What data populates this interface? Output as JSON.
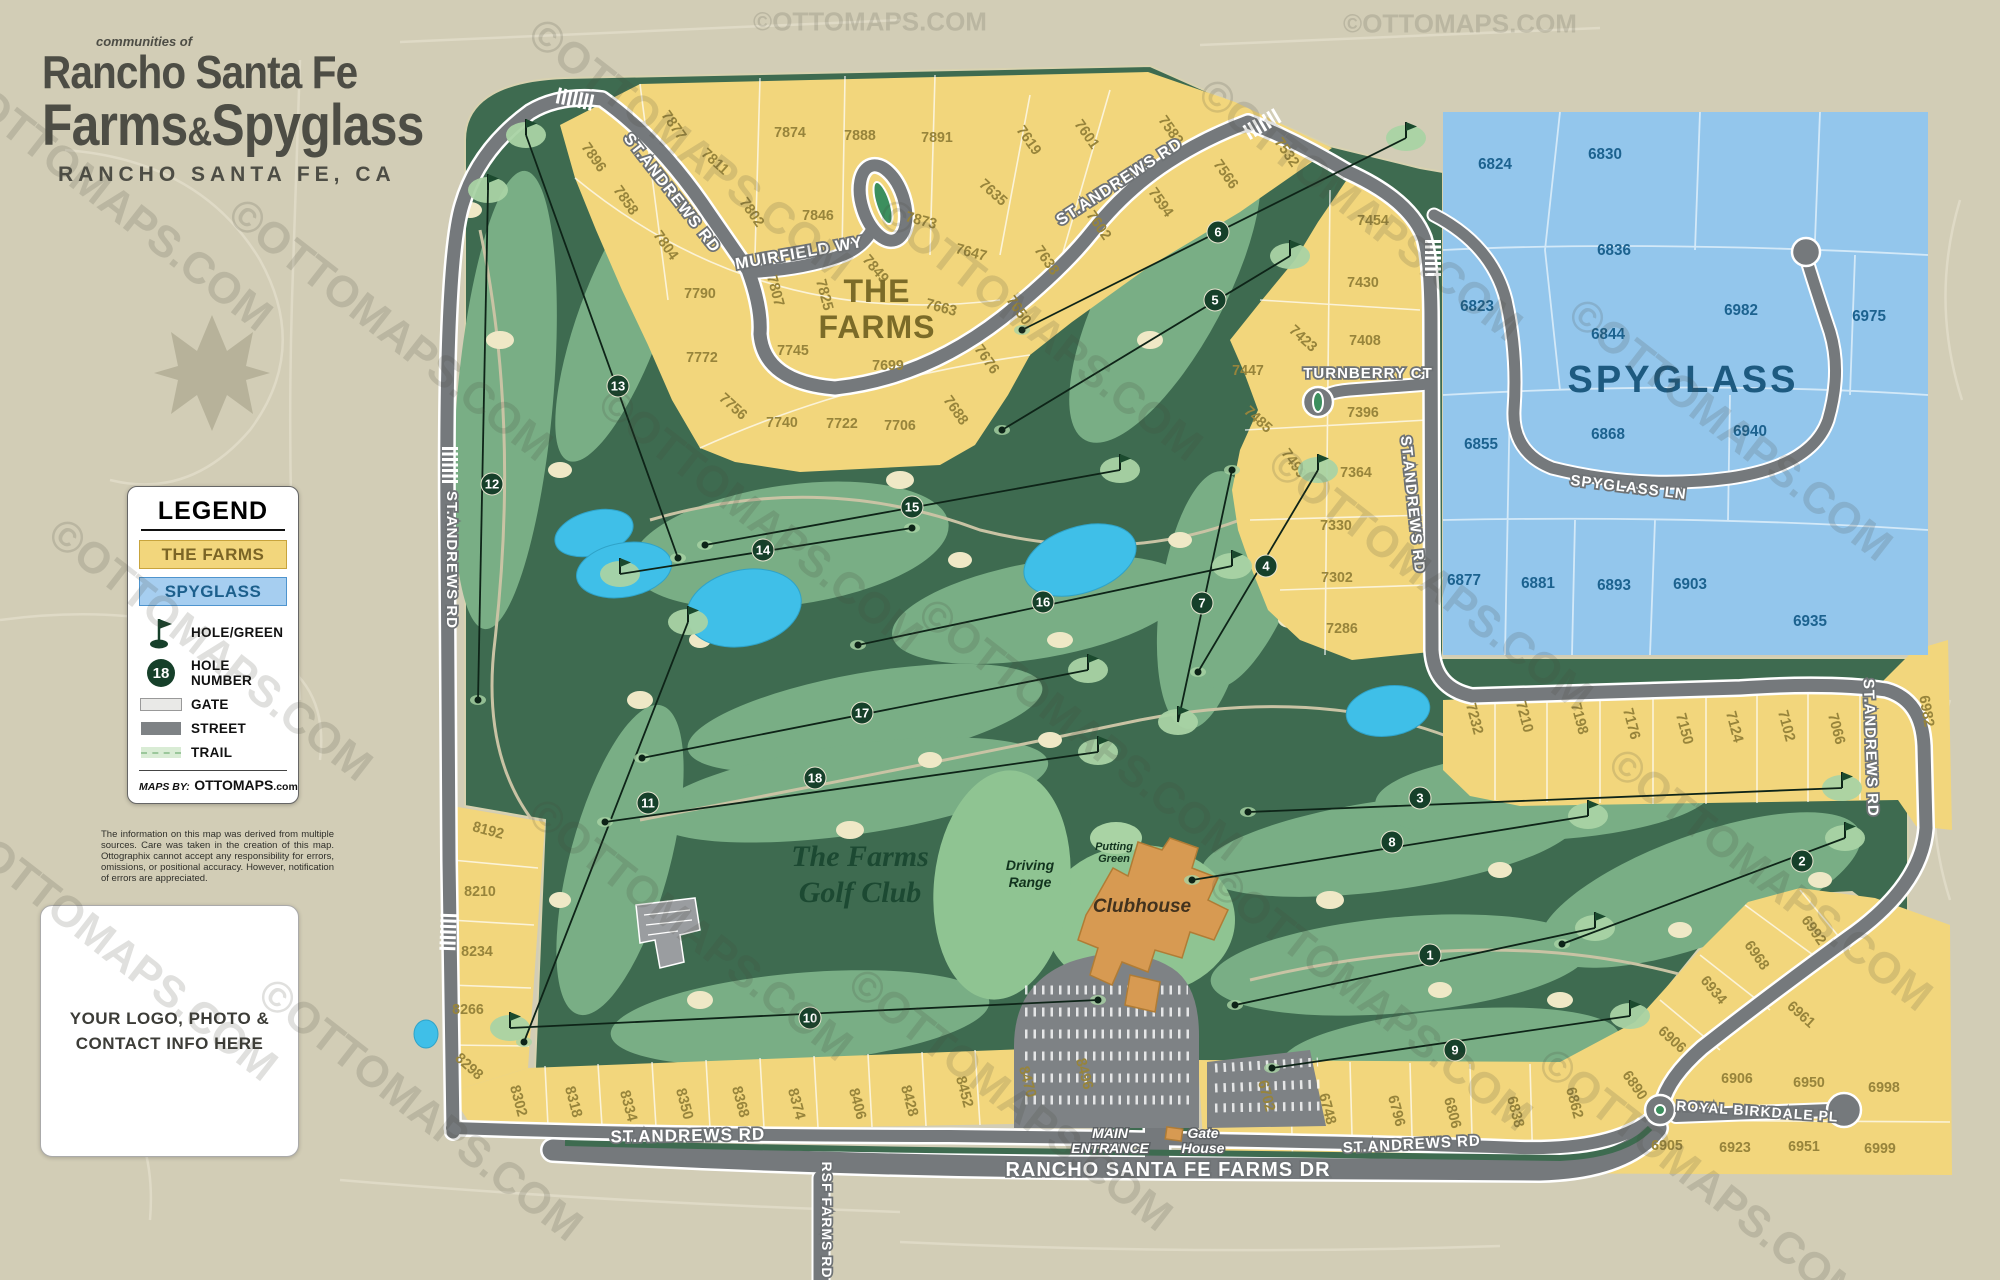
{
  "title": {
    "kicker": "communities of",
    "line1": "Rancho Santa Fe",
    "line2_a": "Farms",
    "amp": "&",
    "line2_b": "Spyglass",
    "subtitle": "RANCHO SANTA FE, CA"
  },
  "legend": {
    "heading": "LEGEND",
    "farms_label": "THE FARMS",
    "spyglass_label": "SPYGLASS",
    "hole_green_label": "HOLE/GREEN",
    "hole_number_label": "HOLE NUMBER",
    "hole_number_example": "18",
    "gate_label": "GATE",
    "street_label": "STREET",
    "trail_label": "TRAIL",
    "maps_by": "MAPS BY:",
    "brand": "OTTOMAPS",
    "brand_suffix": ".com"
  },
  "disclaimer": "The information on this map was derived from multiple sources. Care was taken in the creation of this map. Ottographix cannot accept any responsibility for errors, omissions, or positional accuracy. However, notification of errors are appreciated.",
  "logo_box": {
    "line1": "YOUR LOGO, PHOTO &",
    "line2": "CONTACT INFO HERE"
  },
  "watermark": {
    "text": "©OTTOMAPS.COM",
    "positions": [
      [
        870,
        22,
        26,
        0
      ],
      [
        1460,
        24,
        26,
        0
      ],
      [
        110,
        200,
        44,
        38
      ],
      [
        390,
        330,
        44,
        38
      ],
      [
        210,
        650,
        44,
        38
      ],
      [
        115,
        950,
        44,
        38
      ],
      [
        420,
        1110,
        44,
        38
      ],
      [
        690,
        150,
        44,
        38
      ],
      [
        760,
        520,
        44,
        38
      ],
      [
        690,
        930,
        44,
        38
      ],
      [
        1040,
        330,
        44,
        38
      ],
      [
        1080,
        730,
        44,
        38
      ],
      [
        1010,
        1100,
        44,
        38
      ],
      [
        1360,
        210,
        44,
        38
      ],
      [
        1430,
        580,
        44,
        38
      ],
      [
        1370,
        1000,
        44,
        38
      ],
      [
        1730,
        430,
        44,
        38
      ],
      [
        1770,
        880,
        44,
        38
      ],
      [
        1700,
        1180,
        44,
        38
      ]
    ]
  },
  "colors": {
    "farms_fill": "#F2D67C",
    "farms_text": "#97843B",
    "spyglass_fill": "#93C6EC",
    "spyglass_text": "#1C628F",
    "course_green": "#3E6B50",
    "fairway_green": "#79AE85",
    "putting_green": "#A9D3A4",
    "sand": "#EFE8C6",
    "water": "#3FBFE8",
    "street_gray": "#75797C",
    "hole_circle": "#16402A",
    "clubhouse_orange": "#D79A52",
    "background_tan": "#D2CDB6"
  },
  "map": {
    "lots": [
      [
        7896,
        590,
        160,
        55,
        "f"
      ],
      [
        7877,
        670,
        128,
        55,
        "f"
      ],
      [
        7874,
        790,
        137,
        0,
        "f"
      ],
      [
        7888,
        860,
        140,
        0,
        "f"
      ],
      [
        7891,
        937,
        142,
        0,
        "f"
      ],
      [
        7811,
        712,
        165,
        42,
        "f"
      ],
      [
        7858,
        622,
        203,
        55,
        "f"
      ],
      [
        7802,
        748,
        215,
        55,
        "f"
      ],
      [
        7846,
        818,
        220,
        0,
        "f"
      ],
      [
        7873,
        920,
        225,
        15,
        "f"
      ],
      [
        7804,
        662,
        248,
        55,
        "f"
      ],
      [
        7790,
        700,
        298,
        0,
        "f"
      ],
      [
        7807,
        771,
        292,
        75,
        "f"
      ],
      [
        7825,
        820,
        296,
        75,
        "f"
      ],
      [
        7849,
        872,
        272,
        50,
        "f"
      ],
      [
        7772,
        702,
        362,
        0,
        "f"
      ],
      [
        7745,
        793,
        355,
        0,
        "f"
      ],
      [
        7699,
        888,
        370,
        0,
        "f"
      ],
      [
        7663,
        940,
        312,
        15,
        "f"
      ],
      [
        7676,
        983,
        362,
        55,
        "f"
      ],
      [
        7756,
        730,
        410,
        42,
        "f"
      ],
      [
        7740,
        782,
        427,
        0,
        "f"
      ],
      [
        7722,
        842,
        428,
        0,
        "f"
      ],
      [
        7706,
        900,
        430,
        0,
        "f"
      ],
      [
        7688,
        952,
        413,
        55,
        "f"
      ],
      [
        7619,
        1025,
        143,
        55,
        "f"
      ],
      [
        7601,
        1083,
        137,
        55,
        "f"
      ],
      [
        7583,
        1167,
        133,
        55,
        "f"
      ],
      [
        7635,
        990,
        196,
        42,
        "f"
      ],
      [
        7602,
        1095,
        228,
        55,
        "f"
      ],
      [
        7594,
        1157,
        205,
        55,
        "f"
      ],
      [
        7647,
        970,
        257,
        15,
        "f"
      ],
      [
        7638,
        1043,
        263,
        55,
        "f"
      ],
      [
        7650,
        1015,
        313,
        55,
        "f"
      ],
      [
        7566,
        1222,
        177,
        55,
        "f"
      ],
      [
        7532,
        1283,
        155,
        55,
        "f"
      ],
      [
        7454,
        1373,
        225,
        0,
        "f"
      ],
      [
        7430,
        1363,
        287,
        0,
        "f"
      ],
      [
        7423,
        1300,
        342,
        42,
        "f"
      ],
      [
        7408,
        1365,
        345,
        0,
        "f"
      ],
      [
        7447,
        1248,
        375,
        0,
        "f"
      ],
      [
        7485,
        1255,
        423,
        42,
        "f"
      ],
      [
        7396,
        1363,
        417,
        0,
        "f"
      ],
      [
        7499,
        1290,
        466,
        55,
        "f"
      ],
      [
        7364,
        1356,
        477,
        0,
        "f"
      ],
      [
        7330,
        1336,
        530,
        0,
        "f"
      ],
      [
        7302,
        1337,
        582,
        0,
        "f"
      ],
      [
        7286,
        1342,
        633,
        0,
        "f"
      ],
      [
        7232,
        1470,
        720,
        75,
        "f"
      ],
      [
        7210,
        1520,
        718,
        75,
        "f"
      ],
      [
        7198,
        1575,
        720,
        75,
        "f"
      ],
      [
        7176,
        1627,
        725,
        75,
        "f"
      ],
      [
        7150,
        1680,
        730,
        75,
        "f"
      ],
      [
        7124,
        1730,
        728,
        75,
        "f"
      ],
      [
        7102,
        1782,
        727,
        75,
        "f"
      ],
      [
        7066,
        1832,
        730,
        75,
        "f"
      ],
      [
        6982,
        1922,
        712,
        80,
        "f"
      ],
      [
        8192,
        487,
        835,
        15,
        "f"
      ],
      [
        8210,
        480,
        896,
        0,
        "f"
      ],
      [
        8234,
        477,
        956,
        0,
        "f"
      ],
      [
        8266,
        468,
        1014,
        0,
        "f"
      ],
      [
        8298,
        466,
        1070,
        42,
        "f"
      ],
      [
        8302,
        514,
        1102,
        75,
        "f"
      ],
      [
        8318,
        569,
        1103,
        75,
        "f"
      ],
      [
        8334,
        624,
        1107,
        75,
        "f"
      ],
      [
        8350,
        680,
        1105,
        75,
        "f"
      ],
      [
        8368,
        736,
        1103,
        75,
        "f"
      ],
      [
        8374,
        792,
        1105,
        75,
        "f"
      ],
      [
        8406,
        853,
        1105,
        75,
        "f"
      ],
      [
        8428,
        905,
        1102,
        75,
        "f"
      ],
      [
        8452,
        960,
        1093,
        75,
        "f"
      ],
      [
        8470,
        1023,
        1083,
        75,
        "f"
      ],
      [
        8496,
        1080,
        1075,
        75,
        "f"
      ],
      [
        6702,
        1262,
        1097,
        75,
        "f"
      ],
      [
        6748,
        1323,
        1110,
        75,
        "f"
      ],
      [
        6796,
        1392,
        1112,
        75,
        "f"
      ],
      [
        6806,
        1448,
        1114,
        75,
        "f"
      ],
      [
        6838,
        1511,
        1113,
        75,
        "f"
      ],
      [
        6862,
        1570,
        1104,
        75,
        "f"
      ],
      [
        6890,
        1631,
        1088,
        55,
        "f"
      ],
      [
        6906,
        1669,
        1043,
        42,
        "f"
      ],
      [
        6934,
        1710,
        993,
        50,
        "f"
      ],
      [
        6968,
        1753,
        958,
        55,
        "f"
      ],
      [
        6992,
        1810,
        933,
        55,
        "f"
      ],
      [
        6961,
        1798,
        1018,
        42,
        "f"
      ],
      [
        6906,
        1737,
        1083,
        0,
        "f"
      ],
      [
        6950,
        1809,
        1087,
        0,
        "f"
      ],
      [
        6998,
        1884,
        1092,
        0,
        "f"
      ],
      [
        6905,
        1667,
        1150,
        0,
        "f"
      ],
      [
        6923,
        1735,
        1152,
        0,
        "f"
      ],
      [
        6951,
        1804,
        1151,
        0,
        "f"
      ],
      [
        6999,
        1880,
        1153,
        0,
        "f"
      ],
      [
        6824,
        1495,
        169,
        0,
        "s"
      ],
      [
        6830,
        1605,
        159,
        0,
        "s"
      ],
      [
        6836,
        1614,
        255,
        0,
        "s"
      ],
      [
        6823,
        1477,
        311,
        0,
        "s"
      ],
      [
        6844,
        1608,
        339,
        0,
        "s"
      ],
      [
        6982,
        1741,
        315,
        0,
        "s"
      ],
      [
        6975,
        1869,
        321,
        0,
        "s"
      ],
      [
        6855,
        1481,
        449,
        0,
        "s"
      ],
      [
        6868,
        1608,
        439,
        0,
        "s"
      ],
      [
        6940,
        1750,
        436,
        0,
        "s"
      ],
      [
        6877,
        1464,
        585,
        0,
        "s"
      ],
      [
        6881,
        1538,
        588,
        0,
        "s"
      ],
      [
        6893,
        1614,
        590,
        0,
        "s"
      ],
      [
        6903,
        1690,
        589,
        0,
        "s"
      ],
      [
        6935,
        1810,
        626,
        0,
        "s"
      ]
    ],
    "holes": [
      [
        1,
        1430,
        955,
        1235,
        1005,
        1595,
        928
      ],
      [
        2,
        1802,
        861,
        1562,
        944,
        1845,
        838
      ],
      [
        3,
        1420,
        798,
        1248,
        812,
        1842,
        788
      ],
      [
        4,
        1266,
        566,
        1198,
        672,
        1318,
        470
      ],
      [
        5,
        1215,
        300,
        1002,
        430,
        1290,
        256
      ],
      [
        6,
        1218,
        232,
        1022,
        330,
        1406,
        138
      ],
      [
        7,
        1202,
        603,
        1232,
        470,
        1178,
        722
      ],
      [
        8,
        1392,
        842,
        1192,
        880,
        1588,
        816
      ],
      [
        9,
        1455,
        1050,
        1272,
        1068,
        1630,
        1016
      ],
      [
        10,
        810,
        1018,
        1098,
        1000,
        510,
        1028
      ],
      [
        11,
        648,
        803,
        524,
        1042,
        688,
        622
      ],
      [
        12,
        492,
        484,
        478,
        700,
        488,
        190
      ],
      [
        13,
        618,
        386,
        678,
        558,
        526,
        135
      ],
      [
        14,
        763,
        550,
        912,
        528,
        620,
        574
      ],
      [
        15,
        912,
        507,
        705,
        545,
        1120,
        470
      ],
      [
        16,
        1043,
        602,
        858,
        645,
        1232,
        566
      ],
      [
        17,
        862,
        713,
        642,
        758,
        1088,
        670
      ],
      [
        18,
        815,
        778,
        605,
        822,
        1098,
        752
      ]
    ],
    "road_labels": [
      [
        "ST.ANDREWS RD",
        668,
        196,
        52,
        16
      ],
      [
        "ST.ANDREWS RD",
        1122,
        186,
        -33,
        16
      ],
      [
        "MUIRFIELD WY",
        800,
        258,
        -10,
        16
      ],
      [
        "ST.ANDREWS RD",
        447,
        560,
        90,
        15
      ],
      [
        "ST.ANDREWS RD",
        1408,
        505,
        84,
        15
      ],
      [
        "TURNBERRY CT",
        1368,
        378,
        0,
        15
      ],
      [
        "SPYGLASS LN",
        1628,
        492,
        7,
        15
      ],
      [
        "ST.ANDREWS RD",
        1866,
        748,
        88,
        15
      ],
      [
        "ST.ANDREWS RD",
        688,
        1141,
        -1,
        17
      ],
      [
        "ST.ANDREWS RD",
        1412,
        1149,
        -3,
        15
      ],
      [
        "ROYAL BIRKDALE PL",
        1757,
        1116,
        4,
        14
      ],
      [
        "RANCHO SANTA FE FARMS DR",
        1168,
        1176,
        0,
        20
      ],
      [
        "RSF FARMS RD",
        822,
        1220,
        90,
        14
      ]
    ],
    "area_labels": [
      {
        "lines": [
          "THE",
          "FARMS"
        ],
        "x": 877,
        "y": 302,
        "lh": 36,
        "cls": "lbl-farms"
      },
      {
        "lines": [
          "SPYGLASS"
        ],
        "x": 1683,
        "y": 392,
        "lh": 40,
        "cls": "lbl-spyglass"
      },
      {
        "lines": [
          "The Farms",
          "Golf Club"
        ],
        "x": 860,
        "y": 866,
        "lh": 36,
        "cls": "lbl-golfclub"
      },
      {
        "lines": [
          "Clubhouse"
        ],
        "x": 1142,
        "y": 912,
        "lh": 20,
        "cls": "lbl-clubhouse"
      },
      {
        "lines": [
          "Driving",
          "Range"
        ],
        "x": 1030,
        "y": 870,
        "lh": 17,
        "cls": "lbl-small-green"
      },
      {
        "lines": [
          "Putting",
          "Green"
        ],
        "x": 1114,
        "y": 850,
        "lh": 12,
        "cls": "lbl-tiny-green"
      },
      {
        "lines": [
          "MAIN",
          "ENTRANCE"
        ],
        "x": 1110,
        "y": 1138,
        "lh": 15,
        "cls": "lbl-road-white"
      },
      {
        "lines": [
          "Gate",
          "House"
        ],
        "x": 1203,
        "y": 1138,
        "lh": 15,
        "cls": "lbl-road-white"
      }
    ],
    "gates": [
      [
        575,
        99,
        12
      ],
      [
        1262,
        124,
        -30
      ],
      [
        1433,
        258,
        90
      ],
      [
        450,
        465,
        90
      ],
      [
        448,
        932,
        92
      ]
    ]
  }
}
